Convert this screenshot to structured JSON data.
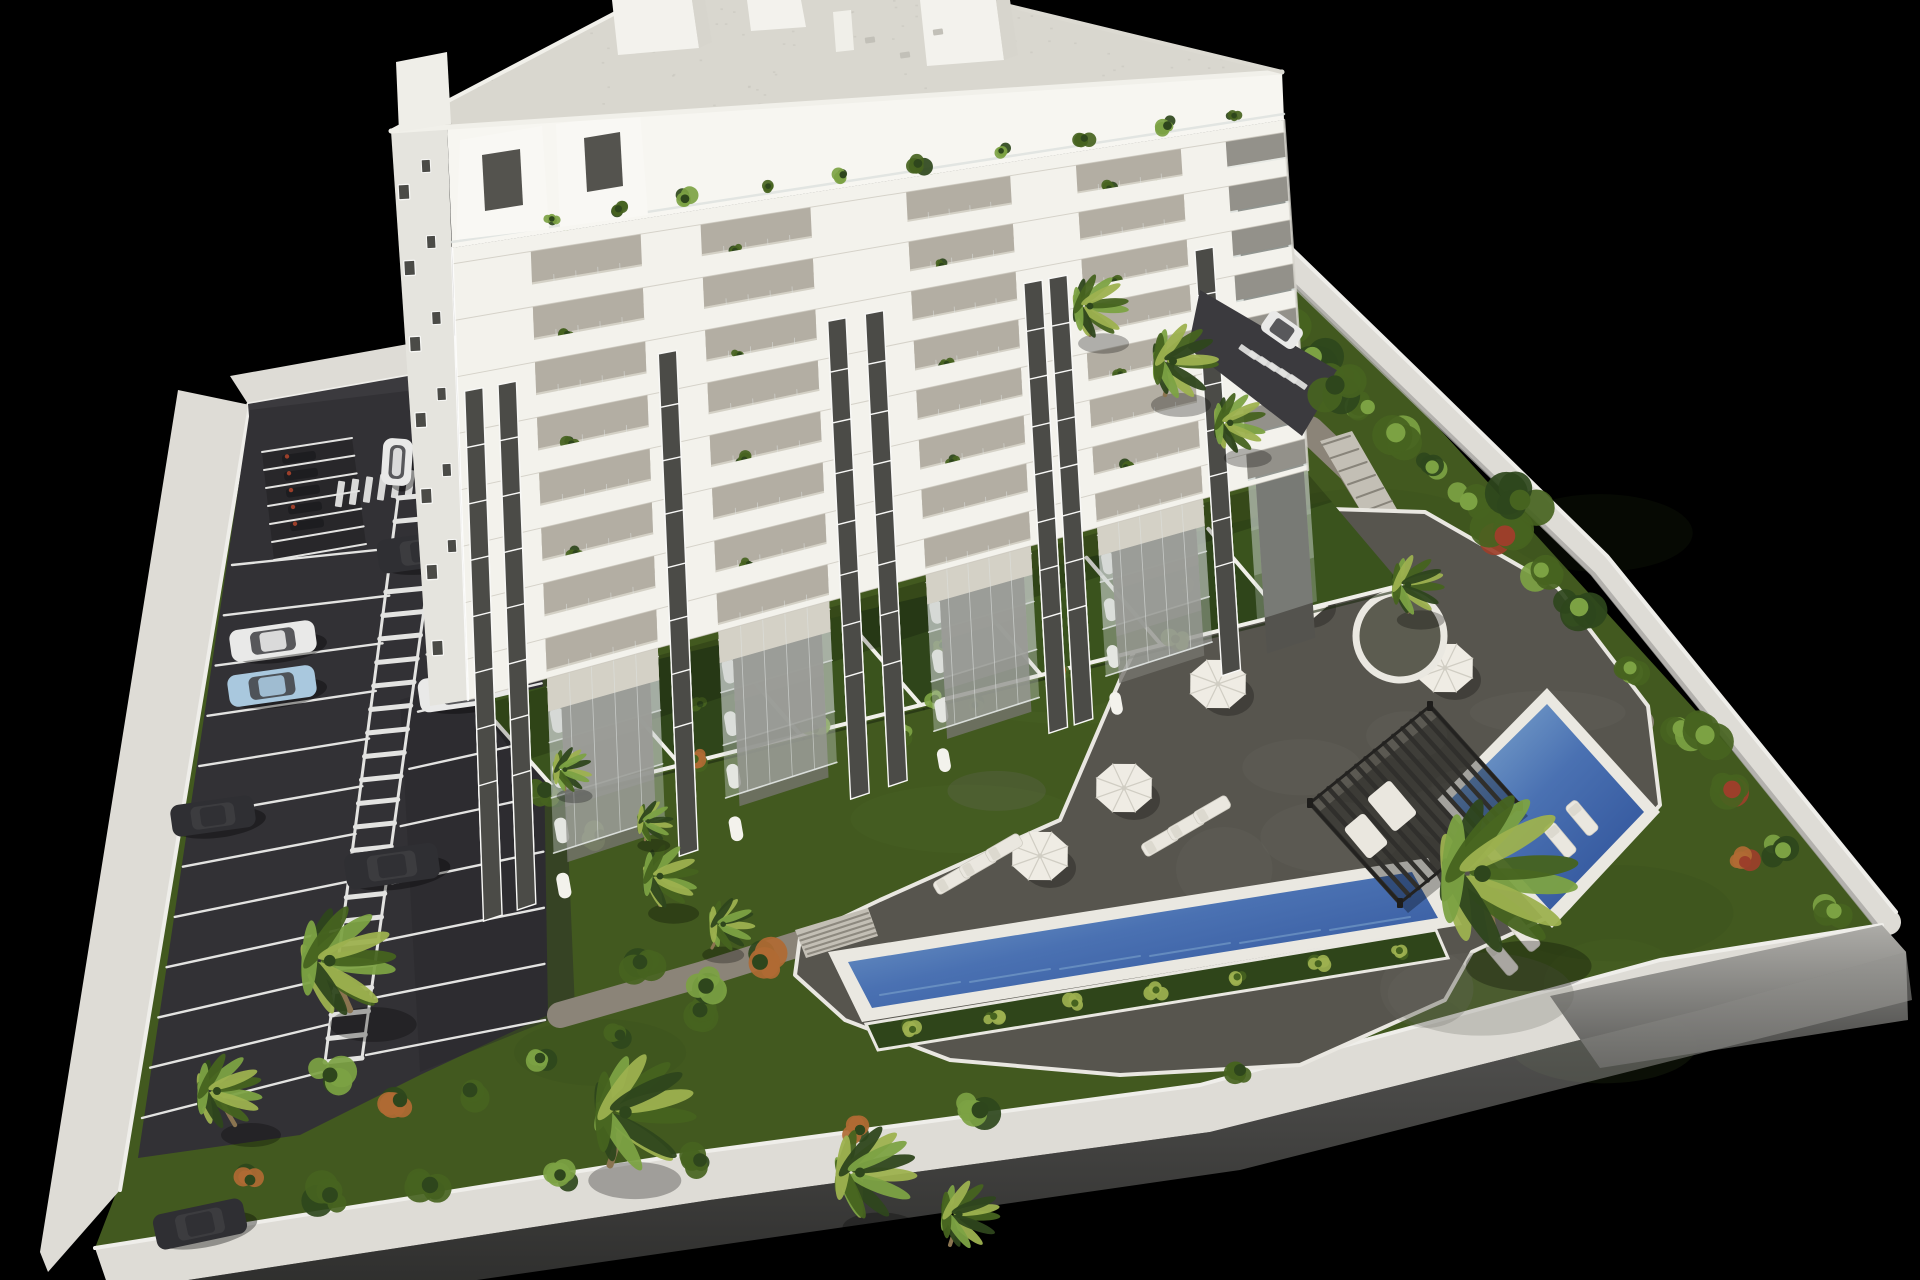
{
  "meta": {
    "description": "Aerial 3D architectural rendering of a white 8-storey apartment building with balconies, landscaped walled garden, two blue swimming pools, slatted pergola, sun loungers, parasols, palm trees and a surface parking lot with cars, isolated on a black background"
  },
  "colors": {
    "background": "#000000",
    "grass": "#42591f",
    "grass_light": "#567230",
    "grass_dark": "#2f451a",
    "wall_top": "#dedcd6",
    "wall_bright": "#efeeea",
    "wall_shade": "#a7a6a2",
    "wall_dark": "#4a4a48",
    "asphalt": "#323135",
    "asphalt_dark": "#28272a",
    "road": "#3b3a3e",
    "line_white": "#e3e3e1",
    "path": "#8b8478",
    "path_edge": "#e9e7e1",
    "steps": "#c3bfb5",
    "deck": "#57554e",
    "deck_light": "#68665e",
    "coping": "#eae8e1",
    "water": "#4a71b2",
    "water_deep": "#2c4e96",
    "water_light": "#85add2",
    "pergola": "#302f2c",
    "umbrella": "#efece4",
    "umbrella_shade": "#d0cdc3",
    "lounger": "#eae7df",
    "building": "#f3f2ec",
    "building_side": "#e5e4de",
    "penthouse": "#f7f6f1",
    "balcony_floor": "#d8d0c0",
    "balcony_shadow": "#b3aea3",
    "glass": "#75746e",
    "glass_dark": "#54534e",
    "railing": "#ccd3cf",
    "window": "#4b4b47",
    "frame": "#f8f8f6",
    "roof": "#d9d7cf",
    "roof_edge": "#f1f0ea",
    "roof_speck": "#c6c4bc",
    "plant": "#46631f",
    "plant_light": "#7ca243",
    "plant_dark": "#2e461c",
    "plant_yellow": "#9db14f",
    "flower_orange": "#b06a33",
    "flower_red": "#9c3f2a",
    "trunk": "#8a7450",
    "car_white": "#e9e9e8",
    "car_blue": "#a9c8de",
    "car_dark": "#2f2f33",
    "car_glass": "#3e3e42"
  },
  "scene": {
    "building": {
      "floors": 8,
      "balcony_bays": 4,
      "window_strips": 5,
      "penthouse_volumes": 2,
      "rooftop_boxes": 3
    },
    "parking": {
      "left_stall_rows": 12,
      "right_stall_rows": 10,
      "walkway_rungs": 24,
      "moto_stalls": 6,
      "cars": [
        {
          "key": "car_white"
        },
        {
          "key": "car_dark"
        },
        {
          "key": "car_white"
        },
        {
          "key": "car_white"
        },
        {
          "key": "car_blue"
        },
        {
          "key": "car_dark"
        },
        {
          "key": "car_dark"
        },
        {
          "key": "car_dark"
        }
      ],
      "rear_drive_car": {
        "key": "car_white"
      }
    },
    "pools": 2,
    "umbrellas": 5,
    "loungers": 10,
    "pergola_slats": 13,
    "palms": 14,
    "hedge_bushes": 16
  }
}
